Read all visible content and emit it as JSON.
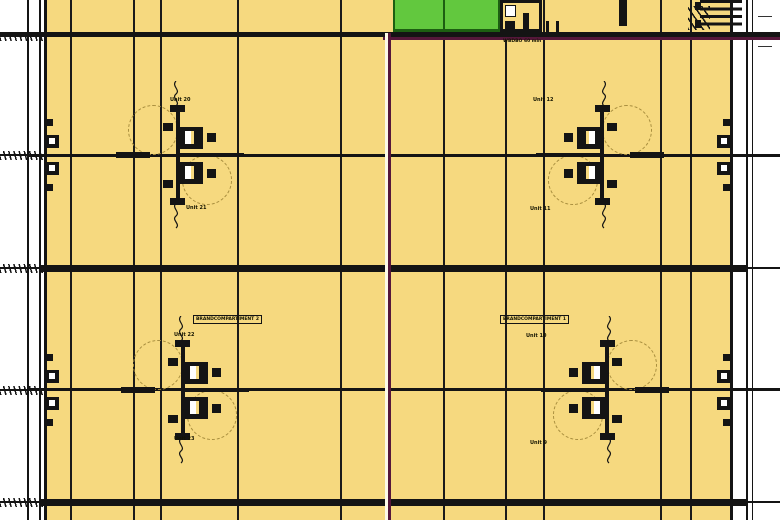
{
  "plan": {
    "floor_color": "#f6d97f",
    "green_room_color": "#62c83e",
    "green_border_color": "#1d5f12",
    "compartment_line_color": "#55173a",
    "line_color": "#141414",
    "door_arc_color": "#a98f3f",
    "fire_wall_label": "WBDBO 60 min",
    "compartments": [
      {
        "label": "BRANDCOMPARTIMENT 2"
      },
      {
        "label": "BRANDCOMPARTIMENT 1"
      }
    ],
    "units": [
      {
        "label": "Unit 20"
      },
      {
        "label": "Unit 12"
      },
      {
        "label": "Unit 21"
      },
      {
        "label": "Unit 11"
      },
      {
        "label": "Unit 22"
      },
      {
        "label": "Unit 10"
      },
      {
        "label": "Unit 23"
      },
      {
        "label": "Unit 9"
      }
    ]
  }
}
